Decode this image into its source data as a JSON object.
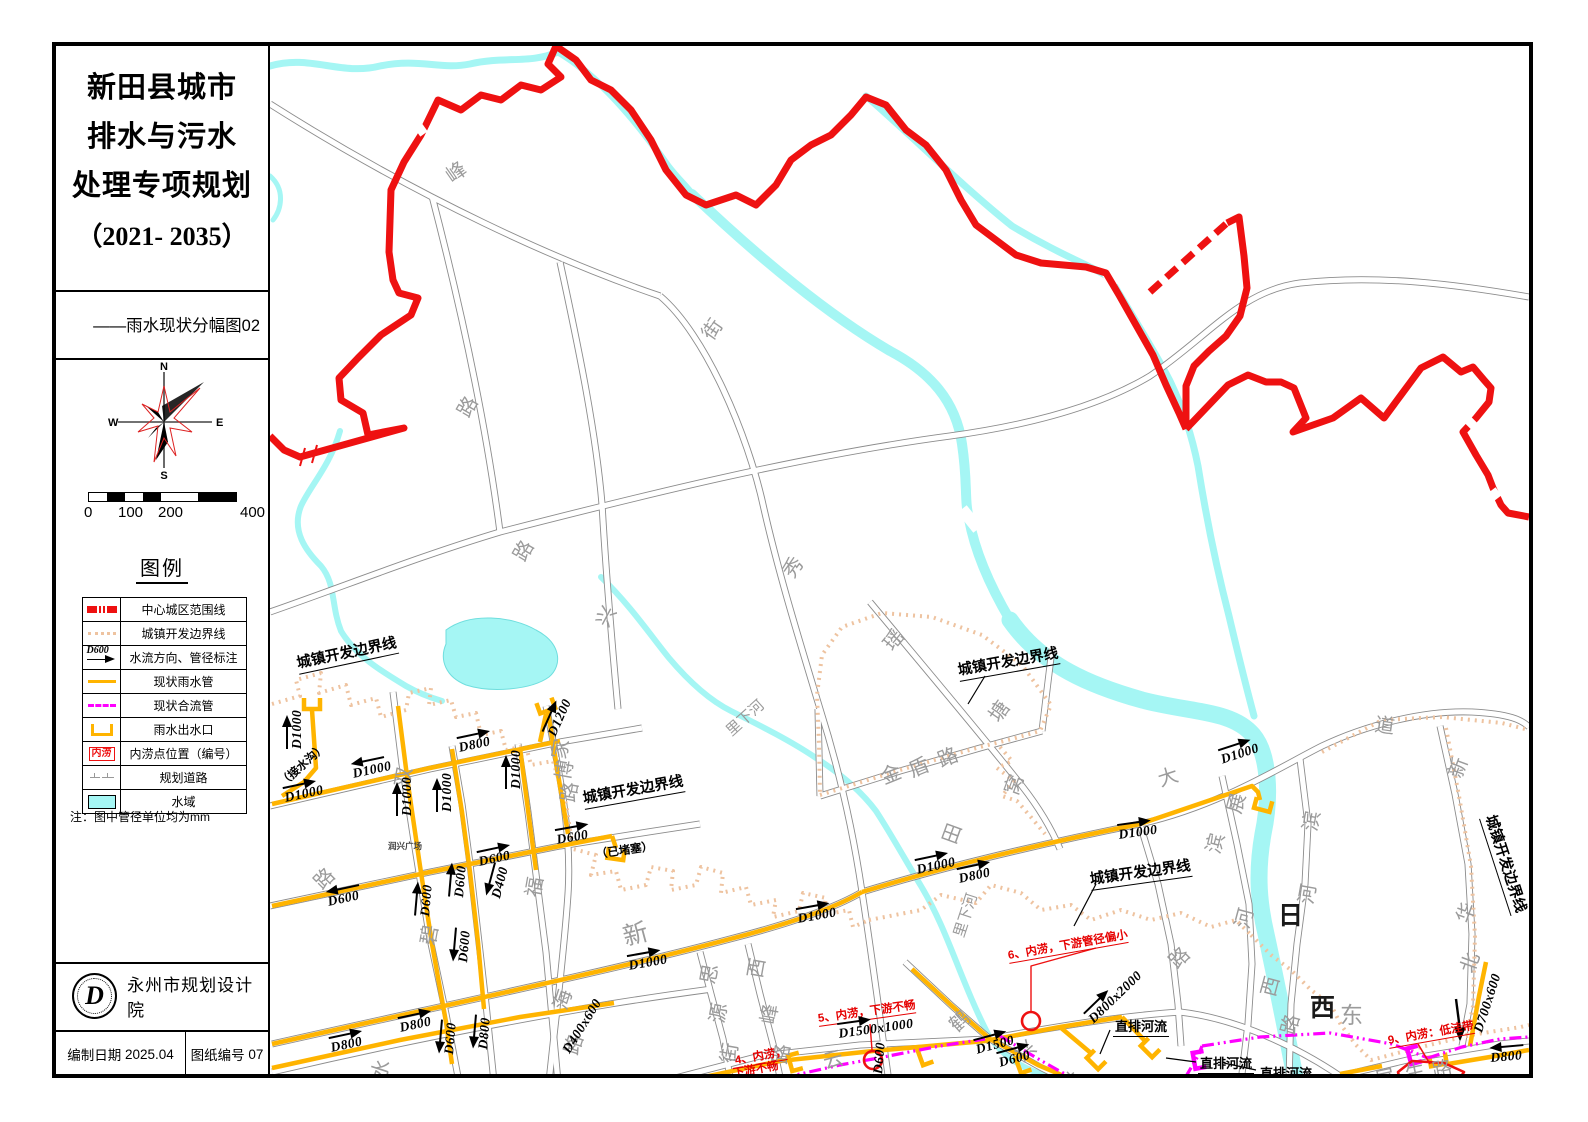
{
  "sheet": {
    "title_lines": [
      "新田县城市",
      "排水与污水",
      "处理专项规划",
      "（2021- 2035）"
    ],
    "subtitle": "——雨水现状分幅图02",
    "compass": {
      "n": "N",
      "e": "E",
      "s": "S",
      "w": "W"
    },
    "scale_ticks": [
      "0",
      "100",
      "200",
      "400"
    ],
    "legend": {
      "title": "图例",
      "items": [
        {
          "label": "中心城区范围线",
          "symbol": "red-dash"
        },
        {
          "label": "城镇开发边界线",
          "symbol": "tan-dot"
        },
        {
          "label": "水流方向、管径标注",
          "symbol": "flow-dir",
          "sym_text": "D600"
        },
        {
          "label": "现状雨水管",
          "symbol": "rain-pipe"
        },
        {
          "label": "现状合流管",
          "symbol": "combined-pipe"
        },
        {
          "label": "雨水出水口",
          "symbol": "outfall"
        },
        {
          "label": "内涝点位置（编号）",
          "symbol": "flood-point",
          "sym_text": "内涝"
        },
        {
          "label": "规划道路",
          "symbol": "planned-road"
        },
        {
          "label": "水域",
          "symbol": "water"
        }
      ],
      "note": "注：图中管径单位均为mm"
    },
    "footer": {
      "logo_letter": "D",
      "org": "永州市规划设计院",
      "date_label": "编制日期",
      "date": "2025.04",
      "sheet_label": "图纸编号",
      "sheet_no": "07"
    }
  },
  "map": {
    "colors": {
      "boundary": "#ee1111",
      "dev_boundary": "#eec3a0",
      "rain_pipe": "#ffb400",
      "combined_pipe": "#ff00ff",
      "water": "#a5f6f4",
      "road": "#8c8c8c"
    },
    "labels": [
      {
        "k": "road",
        "t": "峰",
        "x": 447,
        "y": 158,
        "r": -35
      },
      {
        "k": "road",
        "t": "街",
        "x": 705,
        "y": 318,
        "r": -55
      },
      {
        "k": "road",
        "t": "路",
        "x": 461,
        "y": 396,
        "r": -60
      },
      {
        "k": "road",
        "t": "路",
        "x": 517,
        "y": 540,
        "r": -60
      },
      {
        "k": "road",
        "t": "兴",
        "x": 600,
        "y": 606,
        "r": -62
      },
      {
        "k": "road",
        "t": "秀",
        "x": 786,
        "y": 556,
        "r": -55
      },
      {
        "k": "road",
        "t": "瑶",
        "x": 886,
        "y": 628,
        "r": -50
      },
      {
        "k": "road",
        "t": "塘",
        "x": 992,
        "y": 700,
        "r": -55
      },
      {
        "k": "road",
        "t": "窝",
        "x": 1009,
        "y": 775,
        "r": -70
      },
      {
        "k": "road",
        "t": "田",
        "x": 947,
        "y": 824,
        "r": -70
      },
      {
        "k": "road",
        "t": "金",
        "x": 881,
        "y": 758,
        "r": -22
      },
      {
        "k": "road",
        "t": "盾",
        "x": 909,
        "y": 751,
        "r": -22
      },
      {
        "k": "road",
        "t": "路",
        "x": 938,
        "y": 741,
        "r": -22
      },
      {
        "k": "road",
        "t": "双",
        "x": 400,
        "y": 768,
        "r": -80
      },
      {
        "k": "road",
        "t": "碧",
        "x": 426,
        "y": 926,
        "r": -80
      },
      {
        "k": "road",
        "t": "路",
        "x": 316,
        "y": 866,
        "r": -45
      },
      {
        "k": "road",
        "t": "水",
        "x": 376,
        "y": 1060,
        "r": -72
      },
      {
        "k": "road",
        "t": "家",
        "x": 557,
        "y": 740,
        "r": -80
      },
      {
        "k": "road",
        "t": "博",
        "x": 561,
        "y": 761,
        "r": -80
      },
      {
        "k": "road",
        "t": "路",
        "x": 566,
        "y": 783,
        "r": -80
      },
      {
        "k": "road",
        "t": "福",
        "x": 531,
        "y": 878,
        "r": -80
      },
      {
        "k": "road",
        "t": "新",
        "x": 623,
        "y": 914,
        "r": -15,
        "s": 25
      },
      {
        "k": "road",
        "t": "海",
        "x": 558,
        "y": 990,
        "r": -72
      },
      {
        "k": "road",
        "t": "路",
        "x": 569,
        "y": 1035,
        "r": -72
      },
      {
        "k": "road",
        "t": "思",
        "x": 706,
        "y": 965,
        "r": -80
      },
      {
        "k": "road",
        "t": "源",
        "x": 715,
        "y": 1004,
        "r": -80
      },
      {
        "k": "road",
        "t": "街",
        "x": 726,
        "y": 1044,
        "r": -80
      },
      {
        "k": "road",
        "t": "西",
        "x": 753,
        "y": 959,
        "r": -80
      },
      {
        "k": "road",
        "t": "峰",
        "x": 766,
        "y": 1005,
        "r": -80
      },
      {
        "k": "road",
        "t": "路",
        "x": 778,
        "y": 1045,
        "r": -80
      },
      {
        "k": "road",
        "t": "云",
        "x": 823,
        "y": 1042,
        "r": -15
      },
      {
        "k": "road",
        "t": "鹤",
        "x": 951,
        "y": 1008,
        "r": -42
      },
      {
        "k": "road",
        "t": "兴",
        "x": 1017,
        "y": 1038,
        "r": -42
      },
      {
        "k": "road",
        "t": "林",
        "x": 1062,
        "y": 1069,
        "r": -42
      },
      {
        "k": "road",
        "t": "大",
        "x": 1158,
        "y": 760,
        "r": -18
      },
      {
        "k": "road",
        "t": "道",
        "x": 1375,
        "y": 704,
        "r": 8
      },
      {
        "k": "road",
        "t": "展",
        "x": 1232,
        "y": 794,
        "r": -75
      },
      {
        "k": "road",
        "t": "滨",
        "x": 1211,
        "y": 834,
        "r": -75
      },
      {
        "k": "road",
        "t": "河",
        "x": 1240,
        "y": 909,
        "r": -75
      },
      {
        "k": "road",
        "t": "西",
        "x": 1266,
        "y": 977,
        "r": -75
      },
      {
        "k": "road",
        "t": "路",
        "x": 1286,
        "y": 1015,
        "r": -75
      },
      {
        "k": "road",
        "t": "滨",
        "x": 1308,
        "y": 812,
        "r": -80
      },
      {
        "k": "road",
        "t": "河",
        "x": 1304,
        "y": 885,
        "r": -80
      },
      {
        "k": "gray-big",
        "t": "东",
        "x": 1340,
        "y": 992,
        "r": 0
      },
      {
        "k": "road",
        "t": "新",
        "x": 1453,
        "y": 758,
        "r": -70
      },
      {
        "k": "road",
        "t": "华",
        "x": 1461,
        "y": 903,
        "r": -70
      },
      {
        "k": "road",
        "t": "北",
        "x": 1465,
        "y": 953,
        "r": -70
      },
      {
        "k": "road",
        "t": "路",
        "x": 1171,
        "y": 945,
        "r": -45
      },
      {
        "k": "road",
        "t": "屏",
        "x": 1375,
        "y": 1060,
        "r": -12
      },
      {
        "k": "road",
        "t": "生",
        "x": 1405,
        "y": 1054,
        "r": -12
      },
      {
        "k": "road",
        "t": "路",
        "x": 1432,
        "y": 1051,
        "r": -12
      },
      {
        "k": "big",
        "t": "日",
        "x": 1278,
        "y": 892,
        "r": 0
      },
      {
        "k": "big",
        "t": "西",
        "x": 1310,
        "y": 984,
        "r": 0
      },
      {
        "k": "road",
        "t": "里下河",
        "x": 728,
        "y": 718,
        "r": -42,
        "s": 15
      },
      {
        "k": "road",
        "t": "里下河",
        "x": 958,
        "y": 922,
        "r": -72,
        "s": 15
      },
      {
        "k": "place",
        "t": "润兴广场",
        "x": 388,
        "y": 836,
        "r": 0
      },
      {
        "k": "bnd",
        "t": "城镇开发边界线",
        "x": 297,
        "y": 648,
        "r": -12
      },
      {
        "k": "bnd",
        "t": "城镇开发边界线",
        "x": 583,
        "y": 783,
        "r": -10
      },
      {
        "k": "bnd",
        "t": "城镇开发边界线",
        "x": 958,
        "y": 655,
        "r": -10
      },
      {
        "k": "bnd",
        "t": "城镇开发边界线",
        "x": 1090,
        "y": 864,
        "r": -8
      },
      {
        "k": "bnd",
        "t": "城镇开发边界线",
        "x": 1490,
        "y": 800,
        "r": 72
      },
      {
        "k": "paren",
        "t": "（接水沟）",
        "x": 281,
        "y": 772,
        "r": -42
      },
      {
        "k": "paren",
        "t": "（已堵塞）",
        "x": 596,
        "y": 842,
        "r": -8
      },
      {
        "k": "red",
        "t": "5、内涝，下游不畅",
        "x": 818,
        "y": 1006,
        "r": -8
      },
      {
        "k": "red",
        "t": "6、内涝，下游管径偏小",
        "x": 1008,
        "y": 943,
        "r": -10
      },
      {
        "k": "red",
        "t": "9、内涝：低洼带",
        "x": 1388,
        "y": 1028,
        "r": -10
      },
      {
        "k": "red",
        "t": "4、内涝，",
        "x": 735,
        "y": 1048,
        "r": -10
      },
      {
        "k": "rednu",
        "t": "下游不畅",
        "x": 733,
        "y": 1061,
        "r": -10
      },
      {
        "k": "zp",
        "t": "直排河流",
        "x": 1113,
        "y": 1012,
        "r": 0
      },
      {
        "k": "zp",
        "t": "直排河流",
        "x": 1198,
        "y": 1049,
        "r": 0
      },
      {
        "k": "zp",
        "t": "直排河流",
        "x": 1258,
        "y": 1059,
        "r": 0
      }
    ],
    "pipe_labels": [
      {
        "t": "D1000",
        "x": 293,
        "y": 745,
        "r": -90,
        "a": "r"
      },
      {
        "t": "D1000",
        "x": 352,
        "y": 766,
        "r": -12,
        "a": "l"
      },
      {
        "t": "D1000",
        "x": 284,
        "y": 790,
        "r": -12,
        "a": "r"
      },
      {
        "t": "D1000",
        "x": 403,
        "y": 812,
        "r": -90,
        "a": "r"
      },
      {
        "t": "D1000",
        "x": 443,
        "y": 808,
        "r": -90,
        "a": "r"
      },
      {
        "t": "D800",
        "x": 458,
        "y": 740,
        "r": -12,
        "a": "r"
      },
      {
        "t": "D1200",
        "x": 548,
        "y": 730,
        "r": -66,
        "a": "r"
      },
      {
        "t": "D1000",
        "x": 512,
        "y": 785,
        "r": -90,
        "a": "r"
      },
      {
        "t": "D600",
        "x": 556,
        "y": 832,
        "r": -10,
        "a": "r"
      },
      {
        "t": "D600",
        "x": 327,
        "y": 894,
        "r": -12,
        "a": "l"
      },
      {
        "t": "D600",
        "x": 421,
        "y": 912,
        "r": -85,
        "a": "r"
      },
      {
        "t": "D600",
        "x": 455,
        "y": 893,
        "r": -85,
        "a": "r"
      },
      {
        "t": "D600",
        "x": 478,
        "y": 854,
        "r": -12,
        "a": "r"
      },
      {
        "t": "D400",
        "x": 492,
        "y": 893,
        "r": -75,
        "a": "l"
      },
      {
        "t": "D600",
        "x": 459,
        "y": 958,
        "r": -85,
        "a": "l"
      },
      {
        "t": "D400x600",
        "x": 566,
        "y": 1052,
        "r": -58,
        "a": "n"
      },
      {
        "t": "D800",
        "x": 399,
        "y": 1020,
        "r": -12,
        "a": "r"
      },
      {
        "t": "D800",
        "x": 330,
        "y": 1040,
        "r": -12,
        "a": "r"
      },
      {
        "t": "D600",
        "x": 445,
        "y": 1050,
        "r": -85,
        "a": "l"
      },
      {
        "t": "D800",
        "x": 479,
        "y": 1045,
        "r": -85,
        "a": "l"
      },
      {
        "t": "D1000",
        "x": 628,
        "y": 958,
        "r": -10,
        "a": "r"
      },
      {
        "t": "D1000",
        "x": 797,
        "y": 911,
        "r": -10,
        "a": "r"
      },
      {
        "t": "D1000",
        "x": 916,
        "y": 862,
        "r": -12,
        "a": "r"
      },
      {
        "t": "D800",
        "x": 958,
        "y": 871,
        "r": -12,
        "a": "r"
      },
      {
        "t": "D1000",
        "x": 1118,
        "y": 827,
        "r": -8,
        "a": "r"
      },
      {
        "t": "D1000",
        "x": 1220,
        "y": 752,
        "r": -18,
        "a": "r"
      },
      {
        "t": "D800x2000",
        "x": 1088,
        "y": 1014,
        "r": -44,
        "a": "r"
      },
      {
        "t": "D1500x1000",
        "x": 838,
        "y": 1026,
        "r": -8,
        "a": "r"
      },
      {
        "t": "D1500",
        "x": 975,
        "y": 1042,
        "r": -15,
        "a": "r"
      },
      {
        "t": "D600",
        "x": 998,
        "y": 1055,
        "r": -15,
        "a": "r"
      },
      {
        "t": "D700x600",
        "x": 1478,
        "y": 1032,
        "r": -72,
        "a": "n"
      },
      {
        "t": "D800",
        "x": 1490,
        "y": 1050,
        "r": -5,
        "a": "l"
      },
      {
        "t": "D600",
        "x": 878,
        "y": 1074,
        "r": -85,
        "a": "n"
      }
    ]
  }
}
